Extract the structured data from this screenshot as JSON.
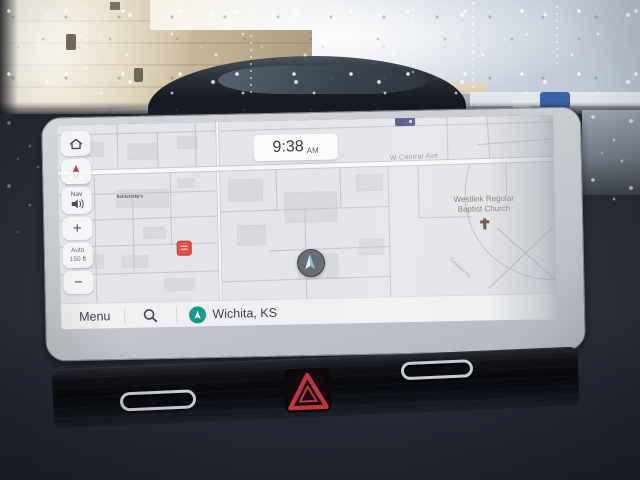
{
  "screen": {
    "status": {
      "time": "9:38",
      "meridiem": "AM"
    },
    "sidebar": {
      "nav_label": "Nav",
      "zoom_in": "+",
      "zoom_out": "−",
      "zoom_mode": "Auto",
      "zoom_scale": "150 ft"
    },
    "bottom_bar": {
      "menu": "Menu",
      "location": "Wichita, KS"
    },
    "map": {
      "street": "W Central Ave",
      "church_name_line1": "Westlink Regular",
      "church_name_line2": "Baptist Church",
      "small_poi": "Schlotzsky's",
      "creek": "Cowskin Ck"
    }
  },
  "icons": {
    "home": "home-icon",
    "compass": "compass-needle-icon",
    "nav_volume": "speaker-icon",
    "search": "magnifier-icon",
    "location": "compass-arrow-icon",
    "church": "cross-icon",
    "poi": "red-poi-icon",
    "vehicle": "vehicle-position-icon",
    "hazard": "hazard-triangle-icon"
  },
  "colors": {
    "map_background": "#e4e5e8",
    "teal_accent": "#17988e",
    "poi_red": "#df5347",
    "hazard_red": "#bf3640",
    "cross_brown": "#7c5648",
    "marker_blue": "#8fbdd1"
  }
}
